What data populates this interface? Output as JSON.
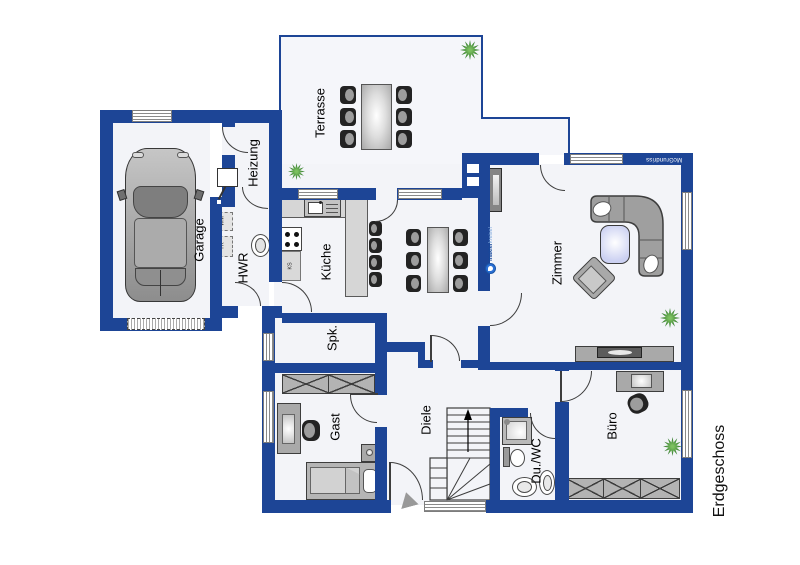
{
  "floor_plan": {
    "title": "Erdgeschoss",
    "brand": "McGrundriss",
    "watermark_bold": "makler",
    "watermark_light": "kreisel",
    "rooms": {
      "garage": "Garage",
      "heizung": "Heizung",
      "hwr": "HWR",
      "kueche": "Küche",
      "terrasse": "Terrasse",
      "zimmer": "Zimmer",
      "spk": "Spk.",
      "gast": "Gast",
      "diele": "Diele",
      "duwc": "Du./WC",
      "buero": "Büro"
    },
    "appliances": {
      "washer": "WM",
      "dryer": "TR",
      "fridge": "KS"
    },
    "colors": {
      "wall": "#1d4596",
      "floor": "#f3f4f8",
      "plant_green": "#246b24",
      "watermark_blue": "#2a6fd4"
    }
  }
}
